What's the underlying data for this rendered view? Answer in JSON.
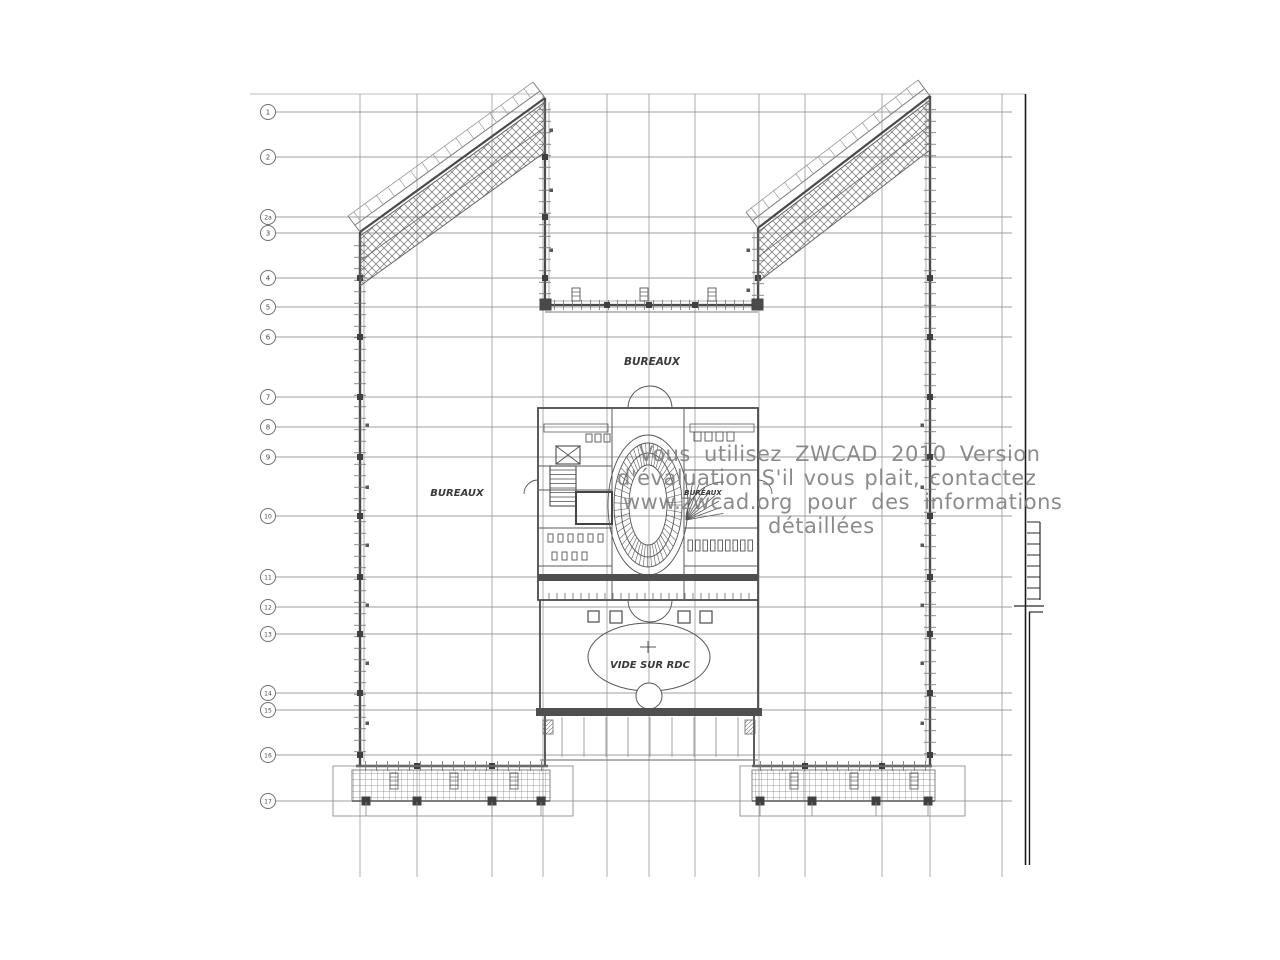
{
  "drawing": {
    "labels": {
      "bureaux_top": "BUREAUX",
      "bureaux_left": "BUREAUX",
      "bureaux_core": "BUREAUX",
      "vide_sur_rdc": "VIDE SUR RDC"
    },
    "grid_axis_labels": [
      "1",
      "2",
      "2a",
      "3",
      "4",
      "5",
      "6",
      "7",
      "8",
      "9",
      "10",
      "11",
      "12",
      "13",
      "14",
      "15",
      "16",
      "17"
    ]
  },
  "watermark": {
    "lines": [
      "Vous utilisez ZWCAD 2010 Version",
      "d'évaluation  S'il vous plait, contactez",
      "www.zwcad.org pour des informations",
      "détaillées"
    ],
    "color": "#828282"
  },
  "colors": {
    "background": "#ffffff",
    "grid_line": "#8f8f8f",
    "wall": "#4a4a4a",
    "hatch": "#6f6f6f",
    "frame": "#1a1a1a",
    "label_text": "#3a3a3a"
  }
}
